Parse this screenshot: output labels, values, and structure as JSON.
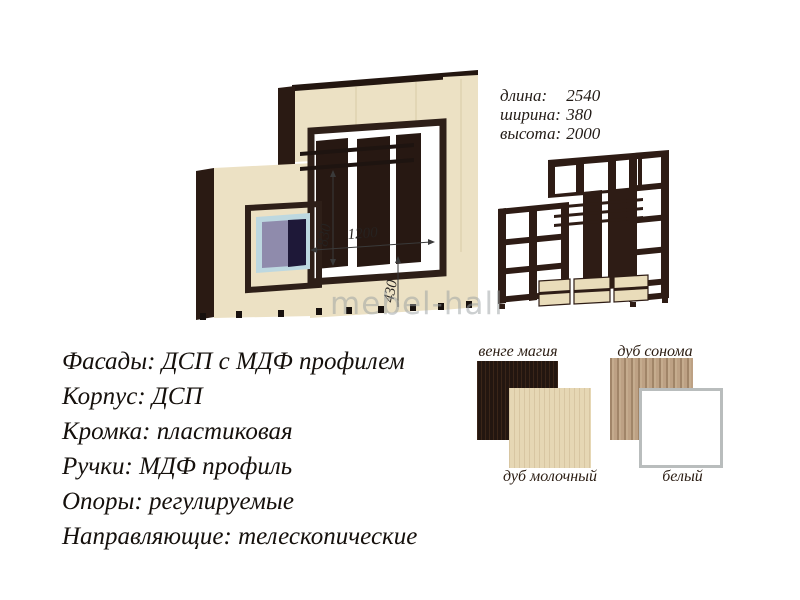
{
  "watermark": {
    "text": "mebel-hall"
  },
  "size_specs": {
    "rows": [
      {
        "label": "длина:",
        "value": "2540"
      },
      {
        "label": "ширина:",
        "value": "380"
      },
      {
        "label": "высота:",
        "value": "2000"
      }
    ]
  },
  "materials": {
    "lines": [
      "Фасады: ДСП  с МДФ профилем",
      "Корпус: ДСП",
      "Кромка: пластиковая",
      "Ручки: МДФ профиль",
      "Опоры: регулируемые",
      "Направляющие: телескопические"
    ]
  },
  "front_view": {
    "description": "wall unit 3d front render",
    "dim_labels": {
      "height": "830",
      "width": "1200",
      "base": "430"
    },
    "colors": {
      "body": "#ece1c4",
      "accent": "#2e1f18",
      "screen_frame": "#bdd8e0",
      "screen": "#8f8bac"
    }
  },
  "skeleton_view": {
    "description": "wall unit carcass render",
    "colors": {
      "frame": "#2e1c15",
      "drawers": "#e9dcba"
    }
  },
  "swatches": {
    "items": [
      {
        "label": "венге магия",
        "color": "#231610"
      },
      {
        "label": "дуб молочный",
        "color": "#e6d7b4"
      },
      {
        "label": "дуб сонома",
        "color": "#bda184"
      },
      {
        "label": "белый",
        "color": "#ffffff",
        "border_color": "#b9bdbd"
      }
    ]
  }
}
